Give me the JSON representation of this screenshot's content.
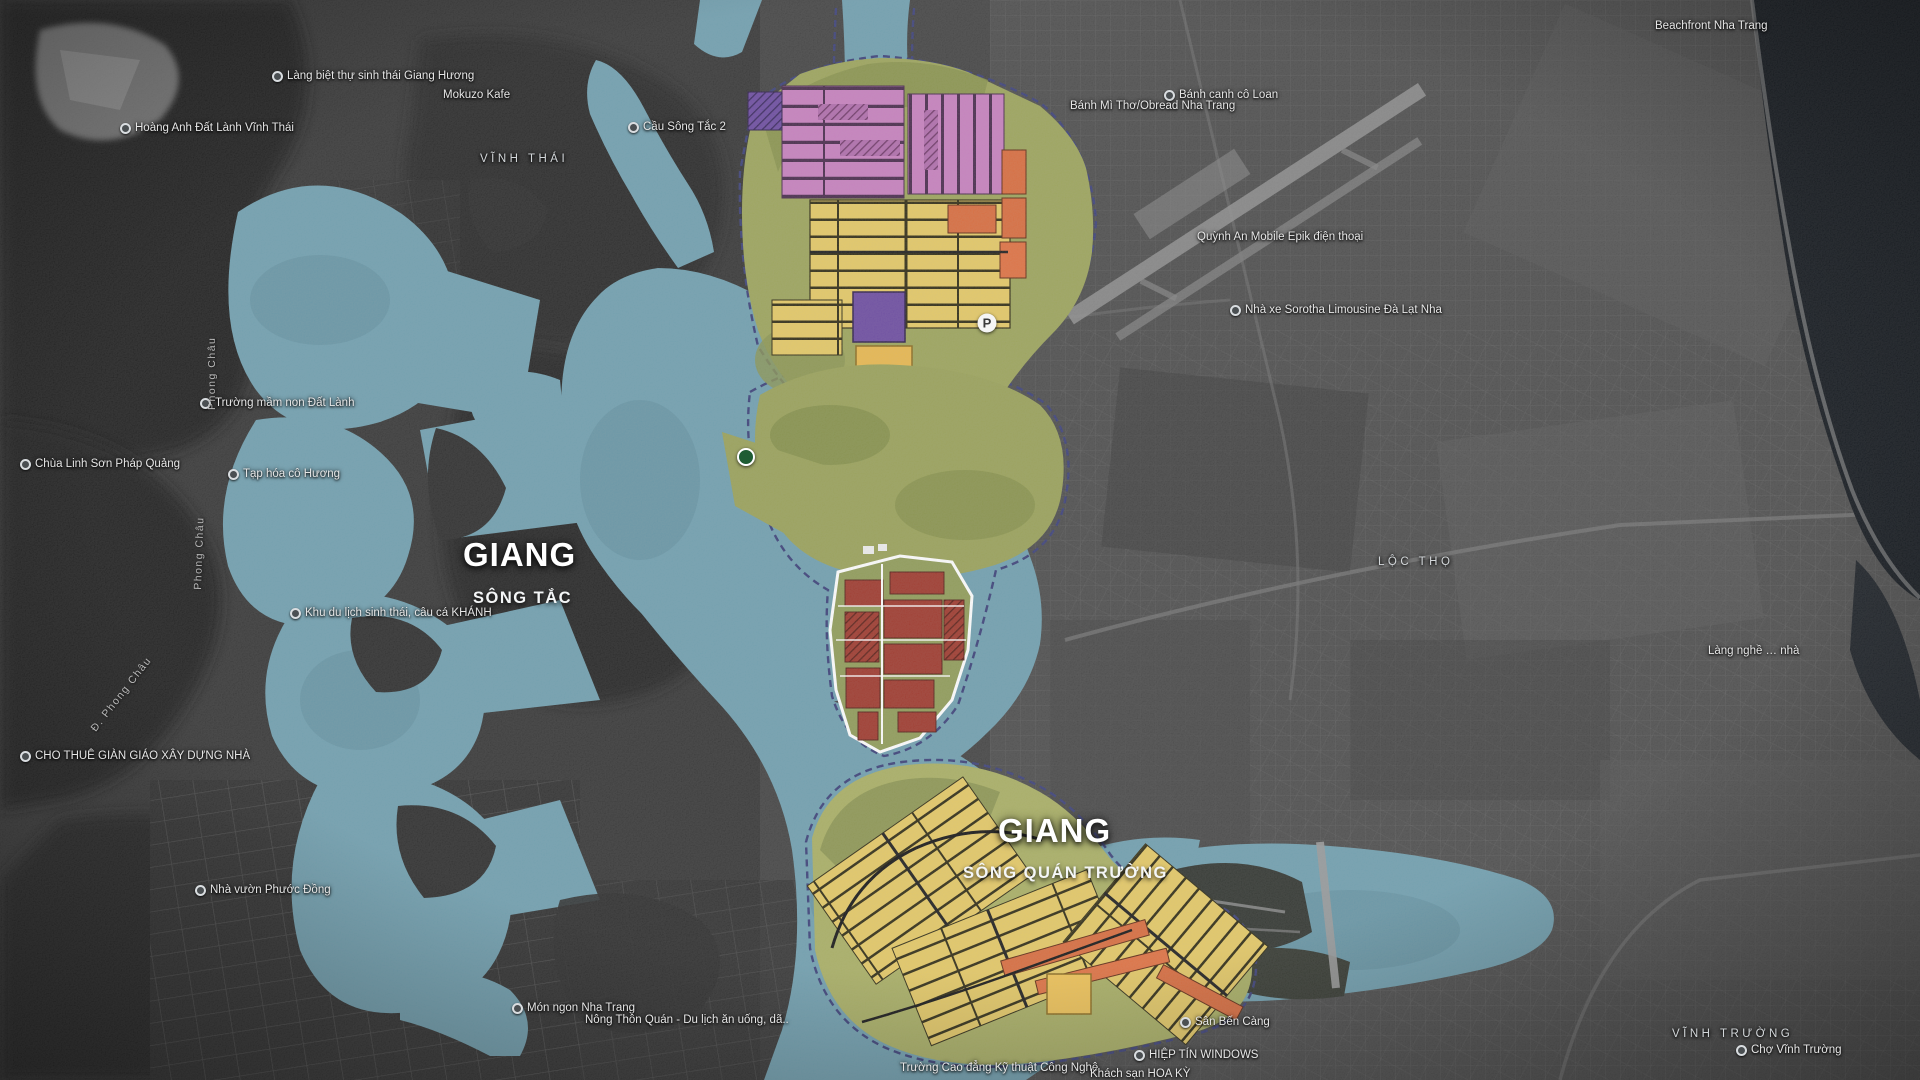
{
  "map": {
    "description": "Satellite basemap of Nha Trang with colored urban master-plan overlay and teal river system",
    "palette": {
      "water": "#6F9FAF",
      "water_deep": "#5E8D9D",
      "plan_green": "#9CA45A",
      "parcel_yellow": "#E5C964",
      "parcel_orange": "#D96B3C",
      "parcel_red": "#9E372B",
      "parcel_pink": "#C77FBE",
      "parcel_purple": "#6B4AA0",
      "parcel_gold": "#E9B84D",
      "boundary_dash": "#3A3F78",
      "label_white": "#FFFFFF",
      "sea_dark": "#10151B"
    },
    "labels": {
      "rivers": [
        {
          "title": "GIANG",
          "title_x": 463,
          "title_y": 536,
          "subtitle": "SÔNG TẮC",
          "subtitle_x": 473,
          "subtitle_y": 589
        },
        {
          "title": "GIANG",
          "title_x": 998,
          "title_y": 812,
          "subtitle": "SÔNG QUÁN TRƯỜNG",
          "subtitle_x": 963,
          "subtitle_y": 864
        }
      ],
      "areas": [
        {
          "text": "VĨNH THÁI",
          "x": 480,
          "y": 153
        },
        {
          "text": "LỘC THỌ",
          "x": 1378,
          "y": 556
        },
        {
          "text": "VĨNH TRƯỜNG",
          "x": 1672,
          "y": 1028
        }
      ],
      "pois": [
        {
          "text": "Làng biệt thự sinh thái Giang Hương",
          "x": 272,
          "y": 70,
          "icon": true
        },
        {
          "text": "Hoàng Anh Đất Lành Vĩnh Thái",
          "x": 120,
          "y": 122,
          "icon": true
        },
        {
          "text": "Mokuzo Kafe",
          "x": 443,
          "y": 89,
          "icon": false
        },
        {
          "text": "Cầu Sông Tắc 2",
          "x": 628,
          "y": 121,
          "icon": true
        },
        {
          "text": "Bánh canh cô Loan",
          "x": 1164,
          "y": 89,
          "icon": true
        },
        {
          "text": "Bánh Mì Thơ/Obread Nha Trang",
          "x": 1070,
          "y": 100,
          "icon": false
        },
        {
          "text": "Beachfront Nha Trang",
          "x": 1655,
          "y": 20,
          "icon": false
        },
        {
          "text": "Quỳnh An Mobile Epik điện thoại",
          "x": 1197,
          "y": 231,
          "icon": false
        },
        {
          "text": "Nhà xe Sorotha Limousine Đà Lạt Nha",
          "x": 1230,
          "y": 304,
          "icon": true
        },
        {
          "text": "Trường mầm non Đất Lành",
          "x": 200,
          "y": 397,
          "icon": true
        },
        {
          "text": "Chùa Linh Sơn Pháp Quảng",
          "x": 20,
          "y": 458,
          "icon": true
        },
        {
          "text": "Tạp hóa cô Hương",
          "x": 228,
          "y": 468,
          "icon": true
        },
        {
          "text": "Khu du lịch sinh thái, câu cá KHÁNH",
          "x": 290,
          "y": 607,
          "icon": true
        },
        {
          "text": "CHO THUÊ GIÀN GIÁO XÂY DỰNG NHÀ",
          "x": 20,
          "y": 750,
          "icon": true
        },
        {
          "text": "Nhà vườn Phước Đồng",
          "x": 195,
          "y": 884,
          "icon": true
        },
        {
          "text": "Món ngon Nha Trang",
          "x": 512,
          "y": 1002,
          "icon": true
        },
        {
          "text": "Nông Thôn Quán - Du lịch ăn uống, dã..",
          "x": 585,
          "y": 1014,
          "icon": false
        },
        {
          "text": "Sân Bến Càng",
          "x": 1180,
          "y": 1016,
          "icon": true
        },
        {
          "text": "HIỆP TÍN WINDOWS",
          "x": 1134,
          "y": 1049,
          "icon": true
        },
        {
          "text": "Trường Cao đẳng Kỹ thuật Công Nghệ",
          "x": 900,
          "y": 1062,
          "icon": false
        },
        {
          "text": "Khách sạn HOA KỲ",
          "x": 1090,
          "y": 1068,
          "icon": false
        },
        {
          "text": "Làng nghề … nhà",
          "x": 1708,
          "y": 645,
          "icon": false
        },
        {
          "text": "Chợ Vĩnh Trường",
          "x": 1736,
          "y": 1044,
          "icon": true
        }
      ],
      "streets": [
        {
          "text": "Phong Châu",
          "x": 218,
          "y": 398,
          "angle": -90
        },
        {
          "text": "Phong Châu",
          "x": 204,
          "y": 578,
          "angle": -88
        },
        {
          "text": "Đ. Phong Châu",
          "x": 98,
          "y": 722,
          "angle": -52
        }
      ],
      "markers": [
        {
          "type": "parking",
          "label": "P",
          "x": 987,
          "y": 323
        },
        {
          "type": "dot",
          "label": "",
          "x": 746,
          "y": 457
        }
      ]
    }
  }
}
